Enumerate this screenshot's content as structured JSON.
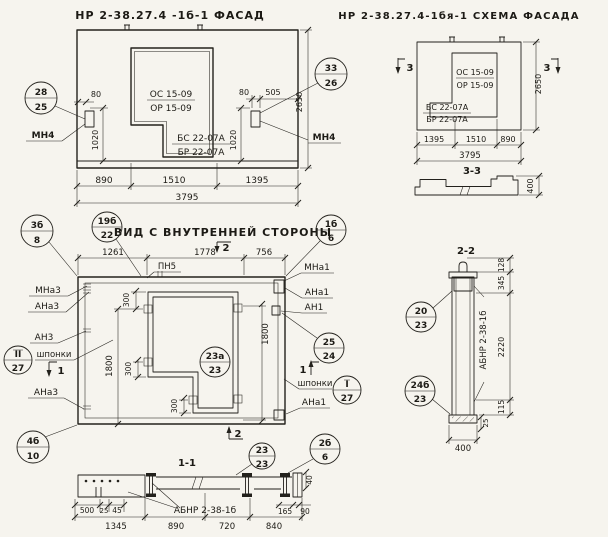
{
  "paper": "#f6f4ee",
  "ink": "#23211c",
  "facade": {
    "title": "НР 2-38.27.4 -1б-1 ФАСАД",
    "callout_left": {
      "top": "28",
      "bot": "25"
    },
    "callout_right": {
      "top": "33",
      "bot": "26"
    },
    "anchor_label_left": "МН4",
    "anchor_label_right": "МН4",
    "opening_marks": {
      "os": "ОС 15-09",
      "or": "ОР 15-09",
      "bs": "БС 22-07А",
      "br": "БР 22-07А"
    },
    "dims": {
      "d80l": "80",
      "d80r": "80",
      "d505": "505",
      "d2650": "2650",
      "d1020l": "1020",
      "d1020r": "1020",
      "bottom": [
        "890",
        "1510",
        "1395"
      ],
      "total": "3795"
    }
  },
  "schema": {
    "title": "НР 2-38.27.4-1бя-1 СХЕМА ФАСАДА",
    "section_mark_left": "3",
    "section_mark_right": "3",
    "opening_marks": {
      "os": "ОС 15-09",
      "or": "ОР 15-09",
      "bs": "БС 22-07А",
      "br": "БР 22-07А"
    },
    "profile_title": "3-3",
    "dims": {
      "d2650": "2650",
      "bottom": [
        "1395",
        "1510",
        "890"
      ],
      "total": "3795",
      "profile_height": "400"
    }
  },
  "inner": {
    "title": "ВИД С ВНУТРЕННЕЙ СТОРОНЫ",
    "pn5": "ПН5",
    "labels_left": [
      "МНа3",
      "АНа3",
      "АН3",
      "шпонки",
      "АНа3"
    ],
    "labels_right": [
      "МНа1",
      "АНа1",
      "АН1",
      "шпонки",
      "АНа1"
    ],
    "callouts": {
      "c3b": {
        "top": "3б",
        "bot": "8"
      },
      "c19b": {
        "top": "19б",
        "bot": "22"
      },
      "c1b": {
        "top": "1б",
        "bot": "6"
      },
      "cII": {
        "top": "II",
        "bot": "27"
      },
      "cI": {
        "top": "I",
        "bot": "27"
      },
      "c25": {
        "top": "25",
        "bot": "24"
      },
      "c23a": {
        "top": "23а",
        "bot": "23"
      },
      "c4b": {
        "top": "4б",
        "bot": "10"
      }
    },
    "section_marks": {
      "s2top": "2",
      "s2bot": "2",
      "s1l": "1",
      "s1r": "1"
    },
    "dims": {
      "top": [
        "1261",
        "1778",
        "756"
      ],
      "d300a": "300",
      "d300b": "300",
      "d300c": "300",
      "d1800l": "1800",
      "d1800r": "1800"
    }
  },
  "sec11": {
    "title": "1-1",
    "label": "АБНР 2-38-1б",
    "callout_23": {
      "top": "23",
      "bot": "23"
    },
    "callout_2b": {
      "top": "2б",
      "bot": "6"
    },
    "dims": {
      "left": [
        "500",
        "25",
        "45"
      ],
      "bottom": [
        "1345",
        "890",
        "720",
        "840"
      ],
      "d165": "165",
      "d90": "90",
      "d40": "40"
    }
  },
  "sec22": {
    "title": "2-2",
    "label": "АБНР 2-38-1б",
    "callout_20": {
      "top": "20",
      "bot": "23"
    },
    "callout_24b": {
      "top": "24б",
      "bot": "23"
    },
    "dims": {
      "d128": "128",
      "d345": "345",
      "d2220": "2220",
      "d115": "115",
      "d25": "25",
      "d400": "400"
    }
  }
}
